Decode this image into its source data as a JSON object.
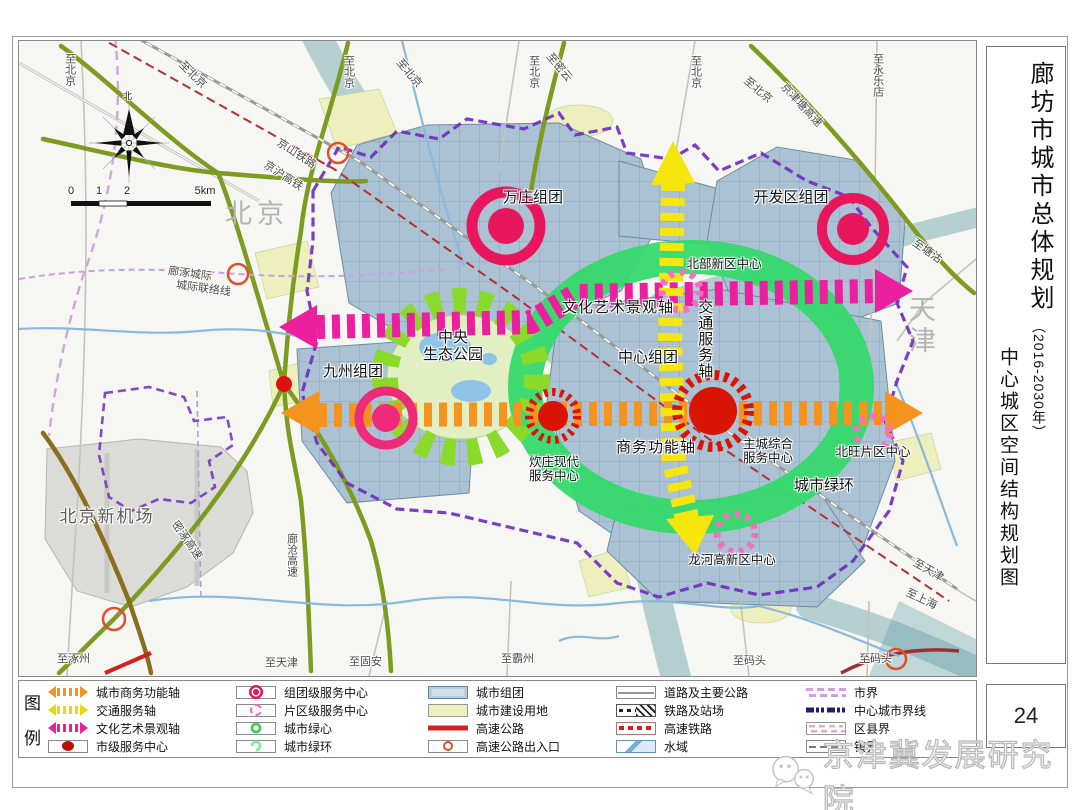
{
  "title": {
    "main": "廊坊市城市总体规划",
    "period": "（2016-2030年）",
    "sub": "中心城区空间结构规划图"
  },
  "page_number": "24",
  "watermark": "京津冀发展研究院",
  "compass_label": "北",
  "scale": {
    "t0": "0",
    "t1": "1",
    "t2": "2",
    "t3": "5km"
  },
  "map": {
    "labels": {
      "wanzhuang": "万庄组团",
      "kaifaqu": "开发区组团",
      "jiuzhou": "九州组团",
      "zhongxin": "中心组团",
      "park": "中央\n生态公园",
      "axis_culture": "文化艺术景观轴",
      "axis_traffic": "交通服务轴",
      "axis_business": "商务功能轴",
      "chuizhuang": "炊庄现代\n服务中心",
      "zhucheng": "主城综合\n服务中心",
      "beiwang": "北旺片区中心",
      "beibu": "北部新区中心",
      "longhe": "龙河高新区中心",
      "green_ring": "城市绿环",
      "beijing": "北京",
      "tianjin": "天津",
      "airport": "北京新机场"
    },
    "roads": {
      "jingshan": "京山铁路",
      "jinghu": "京沪高铁",
      "jingjintang": "京津塘高速",
      "langzhuo": "廊涿城际",
      "lianluo": "城际联络线",
      "mizhuo": "密涿高速",
      "langcang": "廊沧高速"
    },
    "edges": {
      "t1": "至北京",
      "t2": "至北京",
      "t3": "至北京",
      "t4": "至北京",
      "t5": "至密云",
      "t6": "至北京",
      "t7": "至北京",
      "t8": "至永乐店",
      "r1": "至塘沽",
      "r2": "至天津",
      "r3": "至上海",
      "b1": "至涿州",
      "b2": "至天津",
      "b3": "至固安",
      "b4": "至霸州",
      "b5": "至码头",
      "b6": "至码头",
      "l1": "至北京"
    }
  },
  "legend": {
    "title_top": "图",
    "title_bottom": "例",
    "items": [
      {
        "icon": "axis-arrow-orange",
        "label": "城市商务功能轴"
      },
      {
        "icon": "axis-arrow-yellow",
        "label": "交通服务轴"
      },
      {
        "icon": "axis-arrow-magenta",
        "label": "文化艺术景观轴"
      },
      {
        "icon": "city-center",
        "label": "市级服务中心"
      },
      {
        "icon": "cluster-center",
        "label": "组团级服务中心"
      },
      {
        "icon": "district-center",
        "label": "片区级服务中心"
      },
      {
        "icon": "green-heart",
        "label": "城市绿心"
      },
      {
        "icon": "green-ring",
        "label": "城市绿环"
      },
      {
        "icon": "city-cluster",
        "label": "城市组团"
      },
      {
        "icon": "construction-land",
        "label": "城市建设用地"
      },
      {
        "icon": "expressway",
        "label": "高速公路"
      },
      {
        "icon": "expressway-exit",
        "label": "高速公路出入口"
      },
      {
        "icon": "road",
        "label": "道路及主要公路"
      },
      {
        "icon": "railway",
        "label": "铁路及站场"
      },
      {
        "icon": "hsr",
        "label": "高速铁路"
      },
      {
        "icon": "water",
        "label": "水域"
      },
      {
        "icon": "city-boundary",
        "label": "市界"
      },
      {
        "icon": "central-city-boundary",
        "label": "中心城市界线"
      },
      {
        "icon": "county-boundary",
        "label": "区县界"
      },
      {
        "icon": "town-boundary",
        "label": "镇界"
      }
    ]
  },
  "colors": {
    "axis_business": "#f5931f",
    "axis_traffic": "#f6e60e",
    "axis_culture": "#ec1f9f",
    "green_ring": "#35d96b",
    "green_heart": "#8ada2b",
    "city_center": "#d91405",
    "cluster_center": "#e8175d",
    "district_center": "#f470be",
    "urban": "#aac2d3",
    "construction": "#edf0bd",
    "boundary_purple": "#6f2bbf",
    "expressway_red": "#d42020",
    "olive_road": "#7d9b21",
    "water": "#8ab9dd"
  }
}
